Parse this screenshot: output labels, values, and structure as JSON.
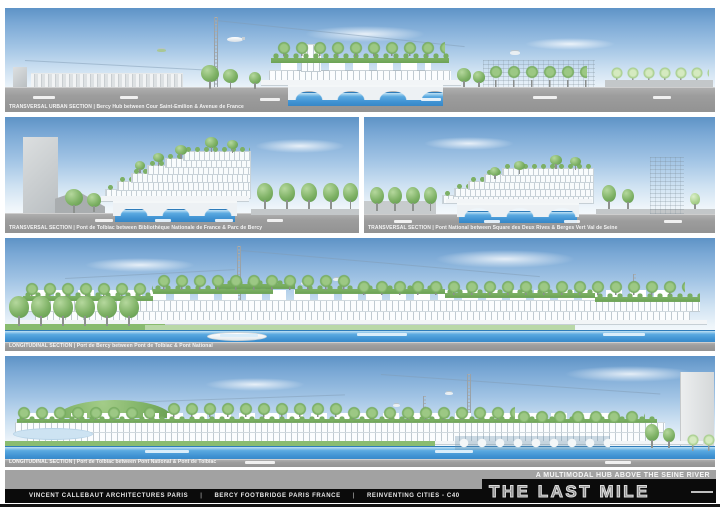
{
  "board": {
    "title": "THE LAST MILE",
    "subtitle": "A MULTIMODAL HUB ABOVE THE SEINE RIVER"
  },
  "footer": {
    "separator": "|",
    "items": [
      "VINCENT CALLEBAUT ARCHITECTURES PARIS",
      "BERCY FOOTBRIDGE PARIS FRANCE",
      "REINVENTING CITIES - C40"
    ]
  },
  "panels": [
    {
      "caption": "TRANSVERSAL URBAN SECTION | Bercy Hub between Cour Saint-Emilion & Avenue de France"
    },
    {
      "caption": "TRANSVERSAL SECTION | Pont de Tolbiac between Bibliothèque Nationale de France & Parc de Bercy"
    },
    {
      "caption": "TRANSVERSAL SECTION | Pont National between Square des Deux Rives & Berges Vert Val de Seine"
    },
    {
      "caption": "LONGITUDINAL SECTION | Port de Bercy between Pont de Tolbiac & Pont National"
    },
    {
      "caption": "LONGITUDINAL SECTION | Port de Tolbiac between Pont National & Pont de Tolbiac"
    }
  ],
  "colors": {
    "sky_top": "#5e93c6",
    "water": "#3f92d2",
    "greenery": "#79ae62",
    "ground": "#9d9d9d",
    "footer_black": "#0b0b0b"
  }
}
